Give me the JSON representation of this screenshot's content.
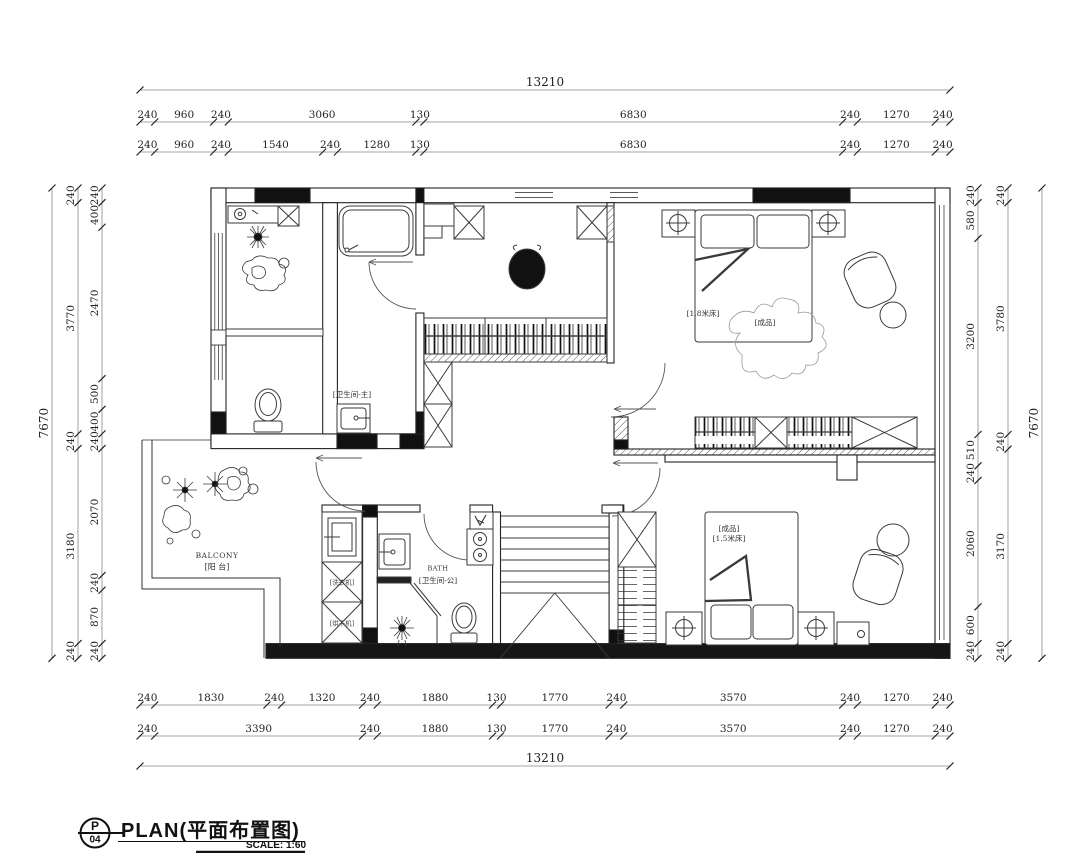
{
  "title_block": {
    "sheet_letter": "P",
    "sheet_number": "04",
    "title": "PLAN(平面布置图)",
    "scale": "SCALE: 1:60"
  },
  "rooms": {
    "master_bath": "[卫生间-主]",
    "public_bath_en": "BATH",
    "public_bath": "[卫生间-公]",
    "balcony_en": "BALCONY",
    "balcony": "[阳 台]",
    "washer": "[洗衣机]",
    "dryer": "[烘干机]",
    "master_bed_size": "[1.8米床]",
    "master_bed_note": "[成品]",
    "bed2_note": "[成品]",
    "bed2_size": "[1.5米床]"
  },
  "dimensions": {
    "units": "mm",
    "plan_width_mm": 13210,
    "plan_height_mm": 7670,
    "strings": [
      {
        "id": "top-total",
        "axis": "h",
        "pos": 90,
        "start": 140,
        "segments": [
          13210
        ]
      },
      {
        "id": "top-row2",
        "axis": "h",
        "pos": 122,
        "start": 140,
        "segments": [
          240,
          960,
          240,
          3060,
          130,
          6830,
          240,
          1270,
          240
        ]
      },
      {
        "id": "top-row3",
        "axis": "h",
        "pos": 152,
        "start": 140,
        "segments": [
          240,
          960,
          240,
          1540,
          240,
          1280,
          130,
          6830,
          240,
          1270,
          240
        ]
      },
      {
        "id": "bottom-row1",
        "axis": "h",
        "pos": 705,
        "start": 140,
        "segments": [
          240,
          1830,
          240,
          1320,
          240,
          1880,
          130,
          1770,
          240,
          3570,
          240,
          1270,
          240
        ]
      },
      {
        "id": "bottom-row2",
        "axis": "h",
        "pos": 736,
        "start": 140,
        "segments": [
          240,
          3390,
          240,
          1880,
          130,
          1770,
          240,
          3570,
          240,
          1270,
          240
        ]
      },
      {
        "id": "bottom-total",
        "axis": "h",
        "pos": 766,
        "start": 140,
        "segments": [
          13210
        ]
      },
      {
        "id": "left-total",
        "axis": "v",
        "pos": 52,
        "start": 188,
        "segments": [
          7670
        ]
      },
      {
        "id": "left-mid",
        "axis": "v",
        "pos": 78,
        "start": 188,
        "segments": [
          240,
          3770,
          240,
          3180,
          240
        ]
      },
      {
        "id": "left-inner",
        "axis": "v",
        "pos": 102,
        "start": 188,
        "segments": [
          240,
          400,
          2470,
          500,
          400,
          240,
          2070,
          240,
          870,
          240
        ]
      },
      {
        "id": "right-inner",
        "axis": "v",
        "pos": 978,
        "start": 188,
        "segments": [
          240,
          580,
          3200,
          510,
          240,
          2060,
          600,
          240
        ]
      },
      {
        "id": "right-mid",
        "axis": "v",
        "pos": 1008,
        "start": 188,
        "segments": [
          240,
          3780,
          240,
          3170,
          240
        ]
      },
      {
        "id": "right-total",
        "axis": "v",
        "pos": 1042,
        "start": 188,
        "segments": [
          7670
        ]
      }
    ]
  }
}
